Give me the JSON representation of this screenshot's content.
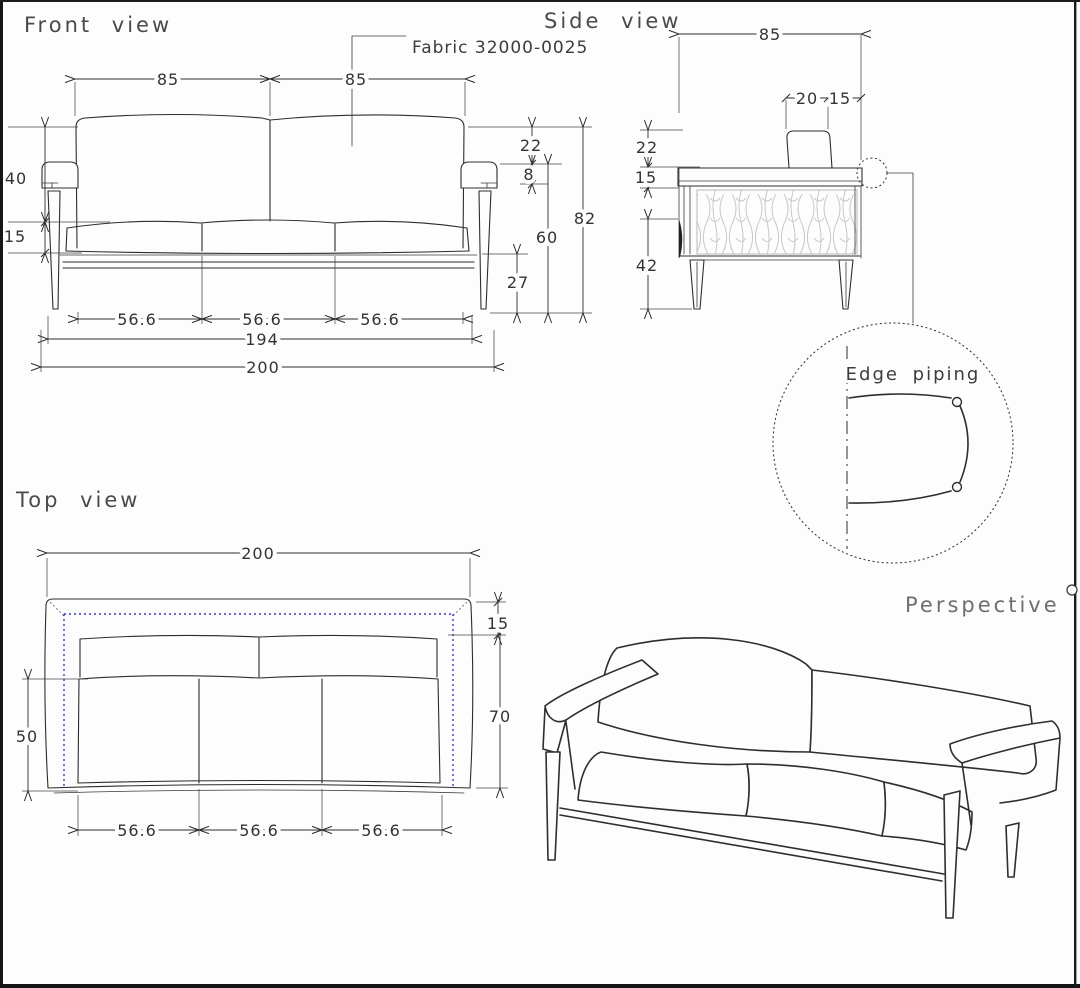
{
  "front": {
    "title": "Front view",
    "fabric_note": "Fabric 32000-0025",
    "dims": {
      "span_left": "85",
      "span_right": "85",
      "back_height": "40",
      "seat_thickness": "15",
      "back_above_arm": "22",
      "piping_offset": "8",
      "overall_height": "82",
      "arm_to_floor": "60",
      "rail_to_floor": "27",
      "seat_1": "56.6",
      "seat_2": "56.6",
      "seat_3": "56.6",
      "frame_width": "194",
      "overall_width": "200"
    }
  },
  "side": {
    "title": "Side view",
    "dims": {
      "overall_depth": "85",
      "headrest_width": "20",
      "headrest_offset": "15",
      "back_above_arm": "22",
      "arm_thickness": "15",
      "leg_height": "42"
    }
  },
  "detail": {
    "label": "Edge piping"
  },
  "top": {
    "title": "Top view",
    "dims": {
      "overall_width": "200",
      "back_depth": "15",
      "inner_depth": "70",
      "seat_depth": "50",
      "seat_1": "56.6",
      "seat_2": "56.6",
      "seat_3": "56.6"
    }
  },
  "perspective": {
    "title": "Perspective"
  },
  "colors": {
    "line": "#2d2d2d",
    "accent_blue": "#3b3bbf",
    "background": "#fdfdfd"
  }
}
